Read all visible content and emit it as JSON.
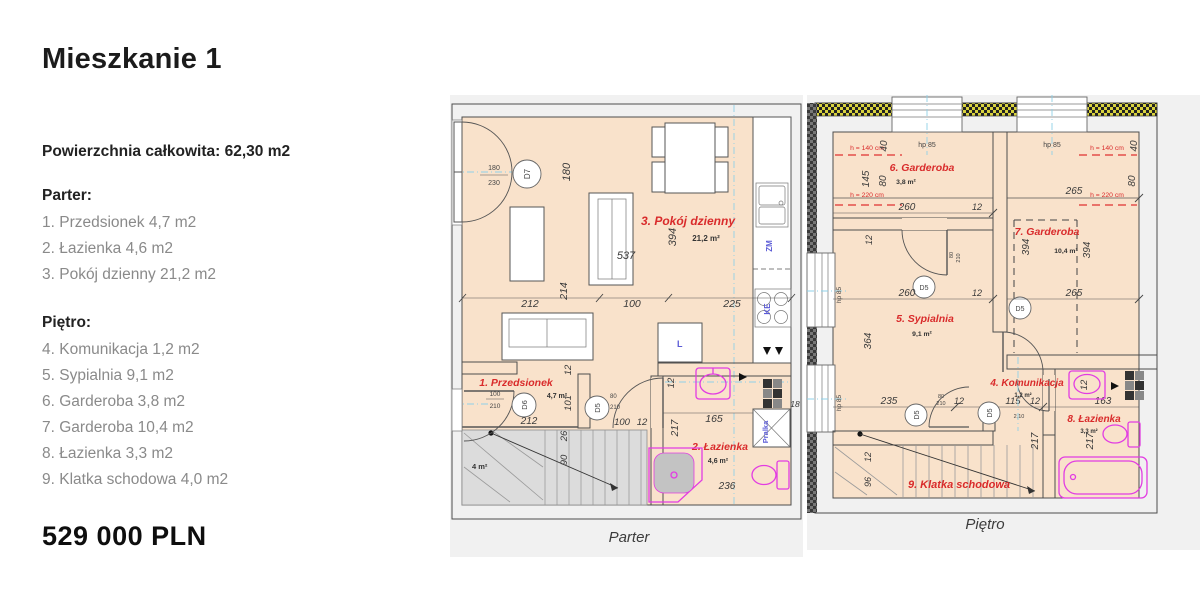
{
  "sidebar": {
    "title": "Mieszkanie 1",
    "total_area": "Powierzchnia całkowita: 62,30 m2",
    "ground_heading": "Parter:",
    "ground_items": [
      "1. Przedsionek 4,7 m2",
      "2. Łazienka 4,6 m2",
      "3. Pokój dzienny 21,2 m2"
    ],
    "upper_heading": "Piętro:",
    "upper_items": [
      "4. Komunikacja 1,2 m2",
      "5. Sypialnia 9,1 m2",
      "6. Garderoba 3,8 m2",
      "7. Garderoba 10,4 m2",
      "8. Łazienka 3,3 m2",
      "9. Klatka schodowa 4,0 m2"
    ],
    "price": "529 000 PLN"
  },
  "colors": {
    "accent_red": "#d92b2b",
    "wall_fill": "#eda77d",
    "wall_hatch": "#a34d2a",
    "floor": "#f9e2cb",
    "fixture_magenta": "#e23ce2",
    "appliance_blue": "#5b5bd6",
    "axis_cyan": "#8fd0e8"
  },
  "parter": {
    "caption": "Parter",
    "rooms": {
      "living": {
        "label": "3. Pokój dzienny",
        "area": "21,2 m²"
      },
      "hall": {
        "label": "1. Przedsionek",
        "area": "4,7 m²"
      },
      "bath": {
        "label": "2. Łazienka",
        "area": "4,6 m²"
      },
      "stairs_area": "4 m²"
    },
    "doors": {
      "d7": "D7",
      "d6": "D6",
      "d5": "D5",
      "balcony_w": "180",
      "balcony_h": "230",
      "d6_w": "100",
      "d6_h": "210",
      "d5_w": "80",
      "d5_h": "210"
    },
    "appliances": {
      "sink": "ZM",
      "hob": "KE",
      "fridge": "L",
      "washer": "Pralka"
    },
    "dims": {
      "top180": "180",
      "diag537": "537",
      "vert394": "394",
      "r212": "212",
      "r214": "214",
      "r100": "100",
      "r225": "225",
      "h212": "212",
      "v12": "12",
      "v101": "101",
      "h100": "100",
      "h12": "12",
      "b12": "12",
      "b165": "165",
      "b48": "48",
      "b18": "18",
      "b217": "217",
      "b236": "236",
      "s90": "90",
      "s26": "26"
    }
  },
  "pietro": {
    "caption": "Piętro",
    "rooms": {
      "ward6": {
        "label": "6. Garderoba",
        "area": "3,8 m²"
      },
      "ward7": {
        "label": "7. Garderoba",
        "area": "10,4 m²"
      },
      "bed": {
        "label": "5. Sypialnia",
        "area": "9,1 m²"
      },
      "komm": {
        "label": "4. Komunikacja",
        "area": "1,2 m²"
      },
      "bath": {
        "label": "8. Łazienka",
        "area": "3,3 m²"
      },
      "stairs": {
        "label": "9. Klatka schodowa"
      }
    },
    "notes": {
      "h140": "h = 140 cm",
      "h220": "h = 220 cm",
      "hp85": "hp 85",
      "d5": "D5",
      "door_w": "80",
      "door_h": "210",
      "t210": "2,10"
    },
    "dims": {
      "v145": "145",
      "v80l": "80",
      "v40l": "40",
      "v40r": "40",
      "v80r": "80",
      "g260": "260",
      "g12": "12",
      "g265": "265",
      "s260": "260",
      "s12": "12",
      "s265": "265",
      "v394a": "394",
      "v394b": "394",
      "v364": "364",
      "v12": "12",
      "r235": "235",
      "r12a": "12",
      "r115": "115",
      "r12b": "12",
      "r163": "163",
      "b12": "12",
      "b217a": "217",
      "b217b": "217",
      "st96": "96",
      "st12": "12"
    }
  }
}
